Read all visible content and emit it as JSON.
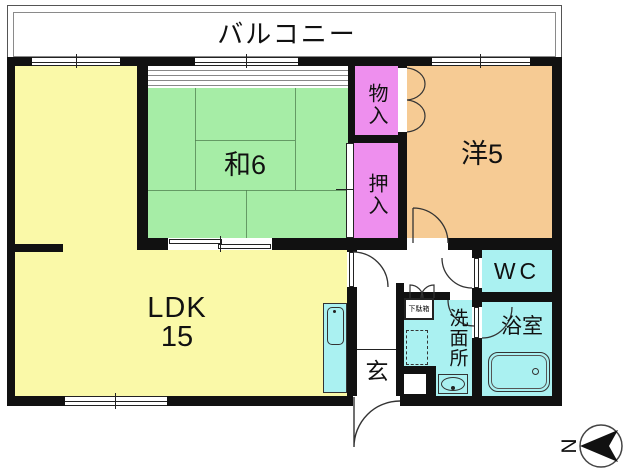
{
  "floorplan": {
    "balcony_label": "バルコニー",
    "rooms": {
      "ldk": {
        "label": "LDK",
        "size": "15"
      },
      "washitsu": {
        "label": "和6"
      },
      "youshitsu": {
        "label": "洋5"
      },
      "storage": {
        "label": "物入"
      },
      "futon_closet": {
        "label": "押入"
      },
      "entrance": {
        "label": "玄"
      },
      "washroom": {
        "label": "洗面所"
      },
      "toilet": {
        "label": "WC"
      },
      "bath": {
        "label": "浴室"
      },
      "shoe_cabinet": {
        "label": "下駄箱"
      }
    },
    "compass": {
      "north_label": "N"
    },
    "colors": {
      "wall": "#111111",
      "ldk_fill": "#FAF9A8",
      "tatami_fill": "#A6EDA6",
      "western_fill": "#F6CB94",
      "closet_fill": "#EE8FEE",
      "water_fill": "#AAF1F1"
    }
  }
}
